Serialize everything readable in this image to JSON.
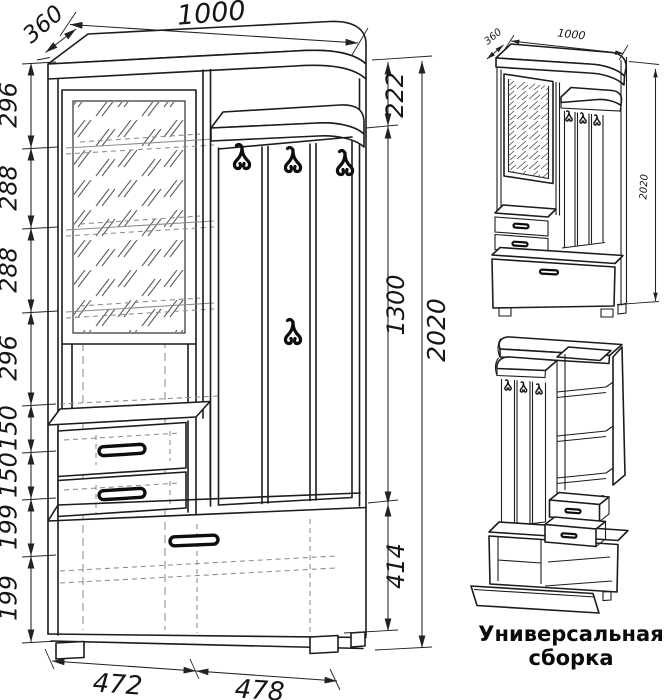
{
  "drawing": {
    "main_view": {
      "width": "1000",
      "depth": "360",
      "height_total": "2020",
      "left_chain": [
        "296",
        "288",
        "288",
        "296",
        "150",
        "150",
        "199",
        "199"
      ],
      "right_chain": [
        "222",
        "1300",
        "414"
      ],
      "bottom_chain": [
        "472",
        "478"
      ]
    },
    "assembly_view": {
      "depth": "360",
      "width": "1000",
      "height": "2020"
    },
    "caption": {
      "line1": "Универсальная",
      "line2": "сборка"
    }
  },
  "style": {
    "line": "#1c1c1c",
    "hidden": "#8b8b8b",
    "background": "#ffffff"
  }
}
